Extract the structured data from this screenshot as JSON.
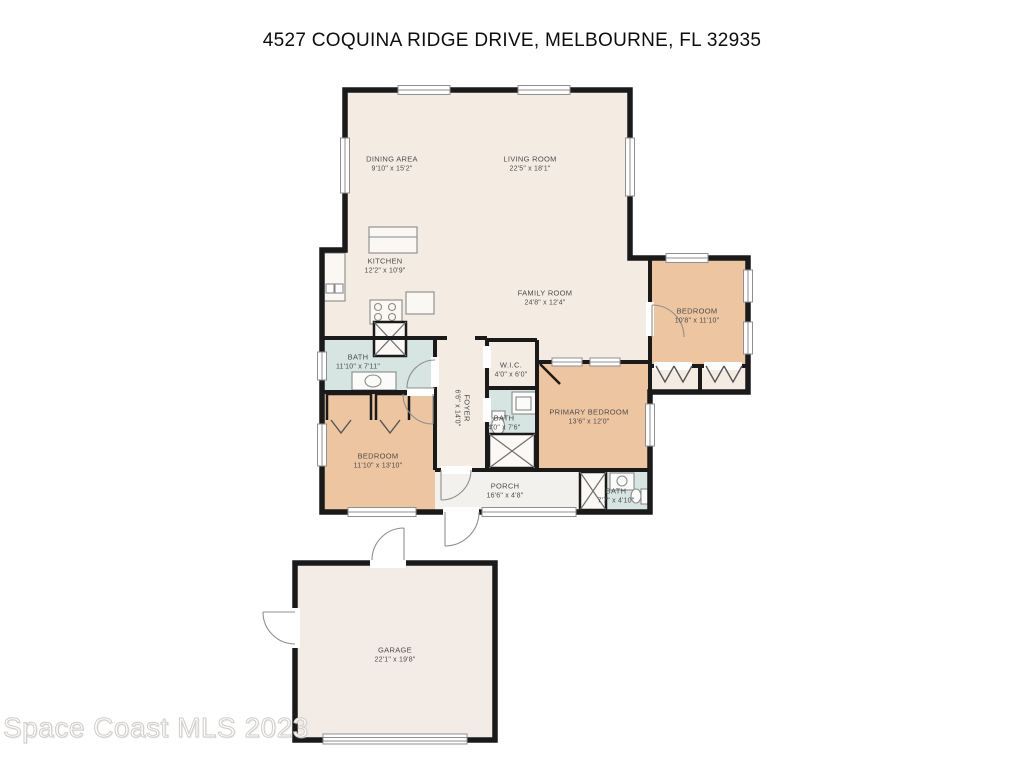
{
  "page": {
    "title": "4527 COQUINA RIDGE DRIVE, MELBOURNE, FL 32935",
    "watermark": "Space Coast MLS 2023"
  },
  "colors": {
    "room_default": "#f4ebe3",
    "bedroom_fill": "#edc5a1",
    "bath_fill": "#d6e4e2",
    "porch_fill": "#f2f1ed",
    "wall": "#1a1a1a",
    "label_text": "#4c4c4c"
  },
  "rooms": [
    {
      "id": "dining-area",
      "name": "DINING AREA",
      "dims": "9'10\" x 15'2\""
    },
    {
      "id": "living-room",
      "name": "LIVING ROOM",
      "dims": "22'5\" x 18'1\""
    },
    {
      "id": "kitchen",
      "name": "KITCHEN",
      "dims": "12'2\" x 10'9\""
    },
    {
      "id": "family-room",
      "name": "FAMILY ROOM",
      "dims": "24'8\" x 12'4\""
    },
    {
      "id": "bedroom-right",
      "name": "BEDROOM",
      "dims": "10'8\" x 11'10\""
    },
    {
      "id": "bath-main",
      "name": "BATH",
      "dims": "11'10\" x 7'11\""
    },
    {
      "id": "foyer",
      "name": "FOYER",
      "dims": "6'6\" x 14'0\""
    },
    {
      "id": "wic",
      "name": "W.I.C.",
      "dims": "4'0\" x 6'0\""
    },
    {
      "id": "bath-hall",
      "name": "BATH",
      "dims": "4'0\" x 7'6\""
    },
    {
      "id": "primary-bedroom",
      "name": "PRIMARY BEDROOM",
      "dims": "13'6\" x 12'0\""
    },
    {
      "id": "bedroom-left",
      "name": "BEDROOM",
      "dims": "11'10\" x 13'10\""
    },
    {
      "id": "porch",
      "name": "PORCH",
      "dims": "16'6\" x 4'8\""
    },
    {
      "id": "bath-porch",
      "name": "BATH",
      "dims": "7'7\" x 4'10\""
    },
    {
      "id": "garage",
      "name": "GARAGE",
      "dims": "22'1\" x 19'8\""
    }
  ]
}
